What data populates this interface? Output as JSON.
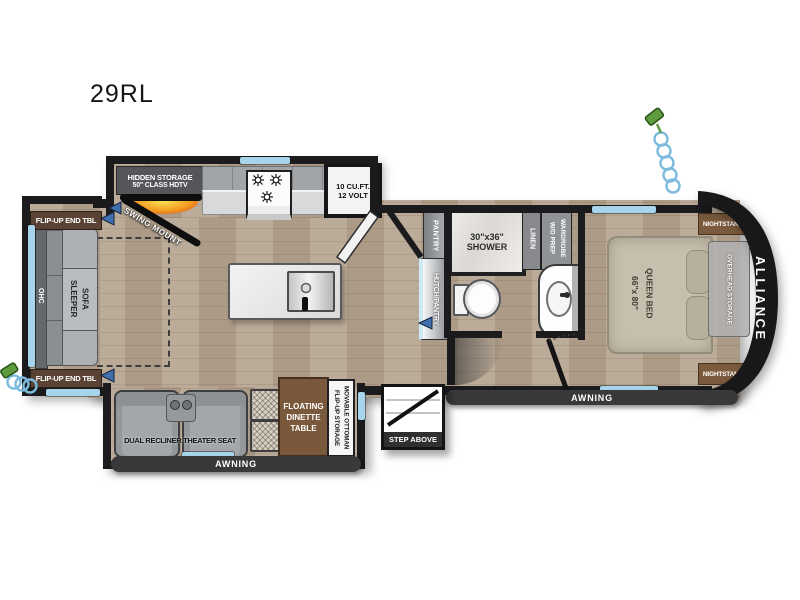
{
  "model": "29RL",
  "brand": "ALLIANCE",
  "living": {
    "hidden_storage": [
      "HIDDEN STORAGE",
      "50\" CLASS HDTV"
    ],
    "swing_mount": "SWING MOUNT",
    "end_table": "FLIP-UP END TBL",
    "ohc": "OHC",
    "sofa": [
      "SLEEPER",
      "SOFA"
    ],
    "theater_seat": "DUAL RECLINER THEATER SEAT",
    "dinette": [
      "FLOATING",
      "DINETTE",
      "TABLE"
    ],
    "ottoman": [
      "MOVABLE OTTOMAN",
      "FLIP-UP STORAGE"
    ]
  },
  "kitchen": {
    "refrigerator": [
      "10 CU.FT.",
      "12 VOLT"
    ],
    "pantry": "PANTRY",
    "hutch": "HUTCH/PANTRY"
  },
  "bathroom": {
    "shower": [
      "30\"x36\"",
      "SHOWER"
    ],
    "linen": "LINEN",
    "wardrobe": [
      "WARDROBE",
      "W/D PREP"
    ]
  },
  "bedroom": {
    "bed": [
      "QUEEN BED",
      "66\"x 80\""
    ],
    "nightstand": "NIGHTSTAND",
    "overhead": "OVERHEAD STORAGE"
  },
  "exterior": {
    "awning": "AWNING",
    "step": "STEP ABOVE"
  },
  "colors": {
    "wall": "#1b1b1d",
    "floor": "#b5a490",
    "window": "#a6d4ea",
    "accent_blue": "#3f6fad",
    "wood_label": "#5a4334",
    "awning_bar": "#39393b",
    "fireplace": "#d0391c"
  }
}
